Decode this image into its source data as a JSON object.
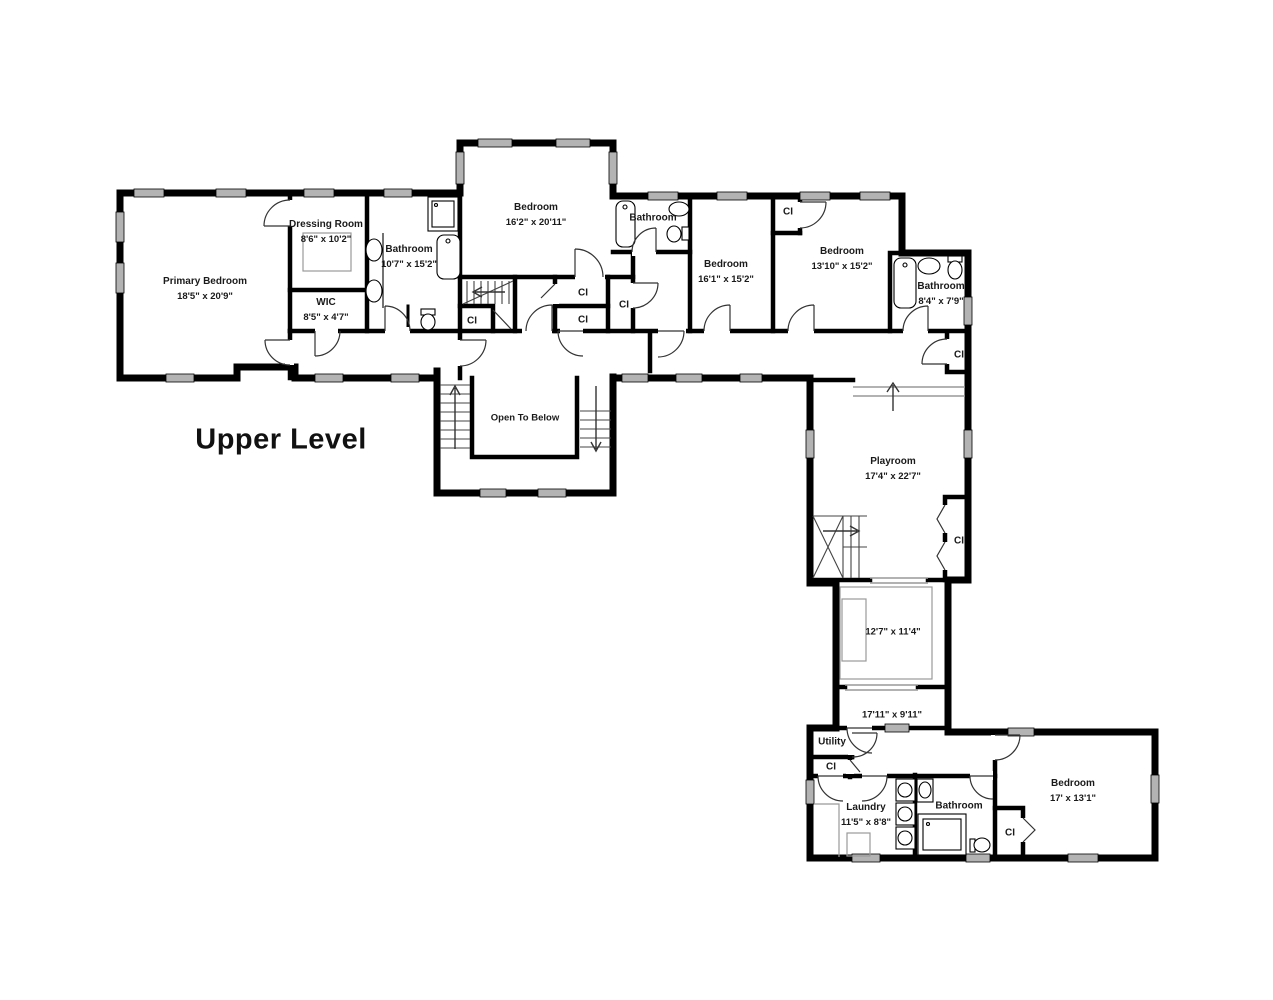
{
  "title": "Upper Level",
  "closet_label": "CI",
  "colors": {
    "wall": "#000000",
    "window_fill": "#b3b3b3",
    "text": "#1a1a1a"
  },
  "rooms": {
    "primary_bedroom": {
      "name": "Primary Bedroom",
      "dims": "18'5\" x 20'9\""
    },
    "dressing_room": {
      "name": "Dressing Room",
      "dims": "8'6\" x 10'2\""
    },
    "wic": {
      "name": "WIC",
      "dims": "8'5\" x 4'7\""
    },
    "primary_bathroom": {
      "name": "Bathroom",
      "dims": "10'7\" x 15'2\""
    },
    "bedroom_top": {
      "name": "Bedroom",
      "dims": "16'2\" x 20'11\""
    },
    "bathroom_mid": {
      "name": "Bathroom",
      "dims": ""
    },
    "bedroom_mid": {
      "name": "Bedroom",
      "dims": "16'1\" x 15'2\""
    },
    "bedroom_right": {
      "name": "Bedroom",
      "dims": "13'10\" x 15'2\""
    },
    "bathroom_right": {
      "name": "Bathroom",
      "dims": "8'4\" x 7'9\""
    },
    "open_to_below": {
      "name": "Open To Below",
      "dims": ""
    },
    "playroom": {
      "name": "Playroom",
      "dims": "17'4\" x 22'7\""
    },
    "room_127": {
      "name": "",
      "dims": "12'7\" x 11'4\""
    },
    "hall_1711": {
      "name": "",
      "dims": "17'11\" x 9'11\""
    },
    "utility": {
      "name": "Utility",
      "dims": ""
    },
    "laundry": {
      "name": "Laundry",
      "dims": "11'5\" x 8'8\""
    },
    "bathroom_bottom": {
      "name": "Bathroom",
      "dims": ""
    },
    "bedroom_bottom": {
      "name": "Bedroom",
      "dims": "17' x 13'1\""
    }
  }
}
